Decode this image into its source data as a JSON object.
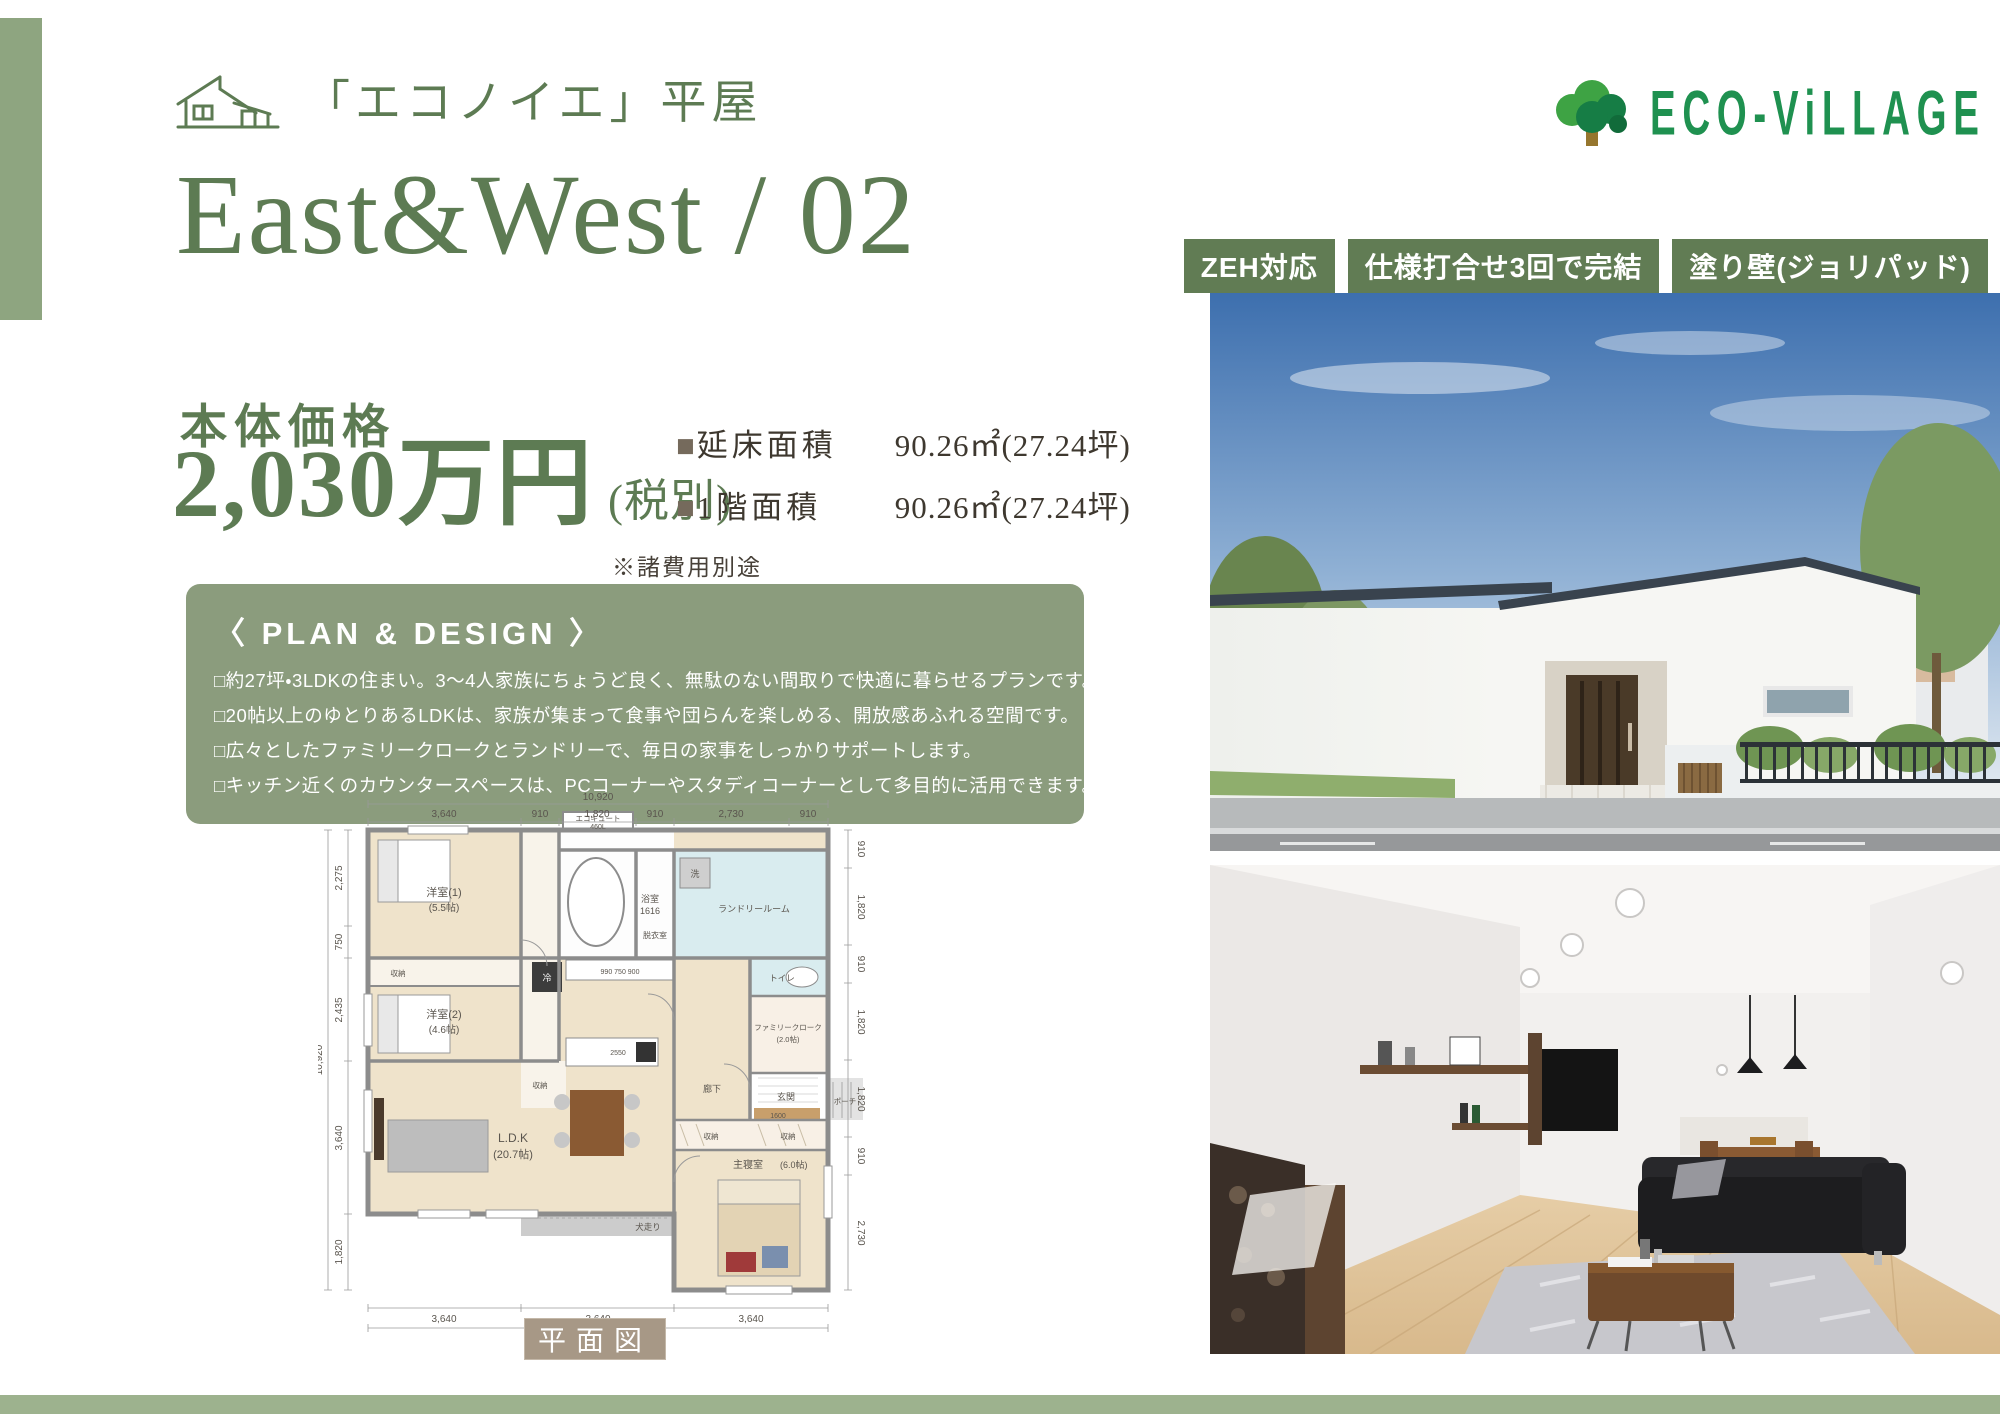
{
  "page": {
    "brand_label": "「エコノイエ」平屋",
    "model_title": "East&West / 02"
  },
  "logo": {
    "name": "ECO-ViLLAGE"
  },
  "badges": [
    {
      "label": "ZEH対応"
    },
    {
      "label": "仕様打合せ3回で完結"
    },
    {
      "label": "塗り壁(ジョリパッド)"
    }
  ],
  "price": {
    "label": "本体価格",
    "amount": "2,030万円",
    "tax_note": "(税別)",
    "fee_note": "※諸費用別途"
  },
  "areas": [
    {
      "bullet": "■",
      "label": "延床面積",
      "value": "90.26㎡(27.24坪)"
    },
    {
      "bullet": "■",
      "label": "1階面積",
      "value": "90.26㎡(27.24坪)"
    }
  ],
  "plan_design": {
    "heading": "〈 PLAN & DESIGN 〉",
    "points": [
      "□約27坪・3LDKの住まい。3～4人家族にちょうど良く、無駄のない間取りで快適に暮らせるプランです。",
      "□20帖以上のゆとりあるLDKは、家族が集まって食事や団らんを楽しめる、開放感あふれる空間です。",
      "□広々としたファミリークロークとランドリーで、毎日の家事をしっかりサポートします。",
      "□キッチン近くのカウンタースペースは、PCコーナーやスタディコーナーとして多目的に活用できます。"
    ]
  },
  "floor_plan": {
    "caption": "平面図",
    "top_total": "10,920",
    "bottom_total": "10,920",
    "left_total": "10,920",
    "top_segments": [
      "3,640",
      "910",
      "1,820",
      "910",
      "2,730",
      "910"
    ],
    "bottom_segments": [
      "3,640",
      "3,640",
      "3,640"
    ],
    "left_segments": [
      "2,275",
      "750",
      "2,435",
      "3,640",
      "1,820"
    ],
    "right_segments": [
      "910",
      "1,820",
      "910",
      "1,820",
      "1,820",
      "910",
      "2,730"
    ],
    "rooms": {
      "bedroom1": "洋室(1)",
      "bedroom1_size": "(5.5帖)",
      "bedroom2": "洋室(2)",
      "bedroom2_size": "(4.6帖)",
      "ldk": "L.D.K",
      "ldk_size": "(20.7帖)",
      "master": "主寝室",
      "master_size": "(6.0帖)",
      "family_closet": "ファミリークローク",
      "family_closet_size": "(2.0帖)",
      "laundry": "ランドリールーム",
      "bath": "浴室",
      "bath_size": "1616",
      "dressing": "脱衣室",
      "washer": "洗",
      "toilet": "トイレ",
      "storage": "収納",
      "hall": "廊下",
      "entrance": "玄関",
      "porch": "ポーチ",
      "ecocute": "エコキュート",
      "ecocute_size": "460L",
      "dog_run": "犬走り",
      "fridge": "冷",
      "counter_dims": "990 750 900",
      "kitchen_dim": "2550",
      "hall_dim": "1600"
    }
  },
  "colors": {
    "accent_green": "#5d7b53",
    "badge_green": "#617c54",
    "panel_green": "#8b9c7d",
    "bar_green": "#9db28e",
    "logo_green": "#1f9150",
    "caption_brown": "#a79886"
  }
}
